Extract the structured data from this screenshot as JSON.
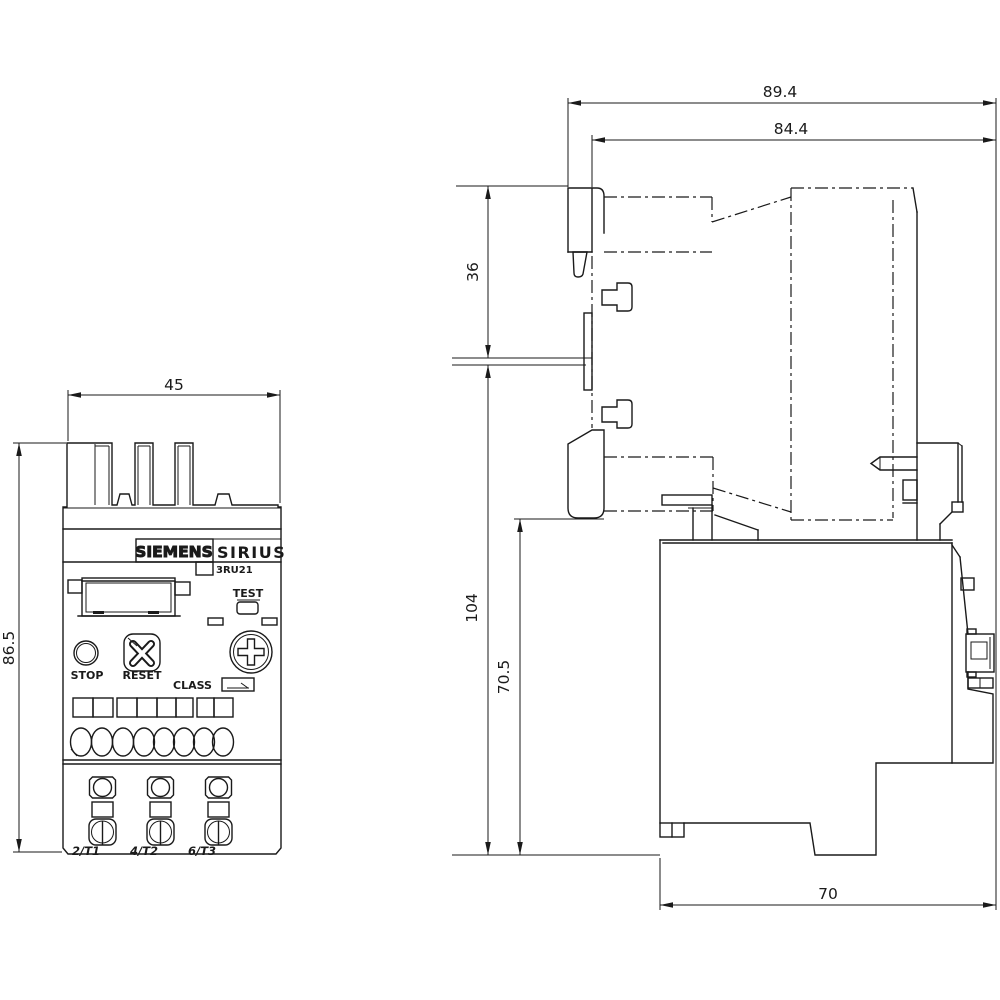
{
  "front": {
    "dim_width": "45",
    "dim_height": "86.5",
    "brand": "SIEMENS",
    "series": "SIRIUS",
    "model": "3RU21",
    "buttons": {
      "test": "TEST",
      "stop": "STOP",
      "reset": "RESET"
    },
    "class_label": "CLASS",
    "terminals": [
      "2/T1",
      "4/T2",
      "6/T3"
    ]
  },
  "side": {
    "dim_total_depth": "89.4",
    "dim_mount_depth": "84.4",
    "dim_top_height": "36",
    "dim_main_height": "104",
    "dim_body_height": "70.5",
    "dim_base_depth": "70"
  },
  "colors": {
    "line": "#1a1a1a",
    "background": "#ffffff"
  }
}
